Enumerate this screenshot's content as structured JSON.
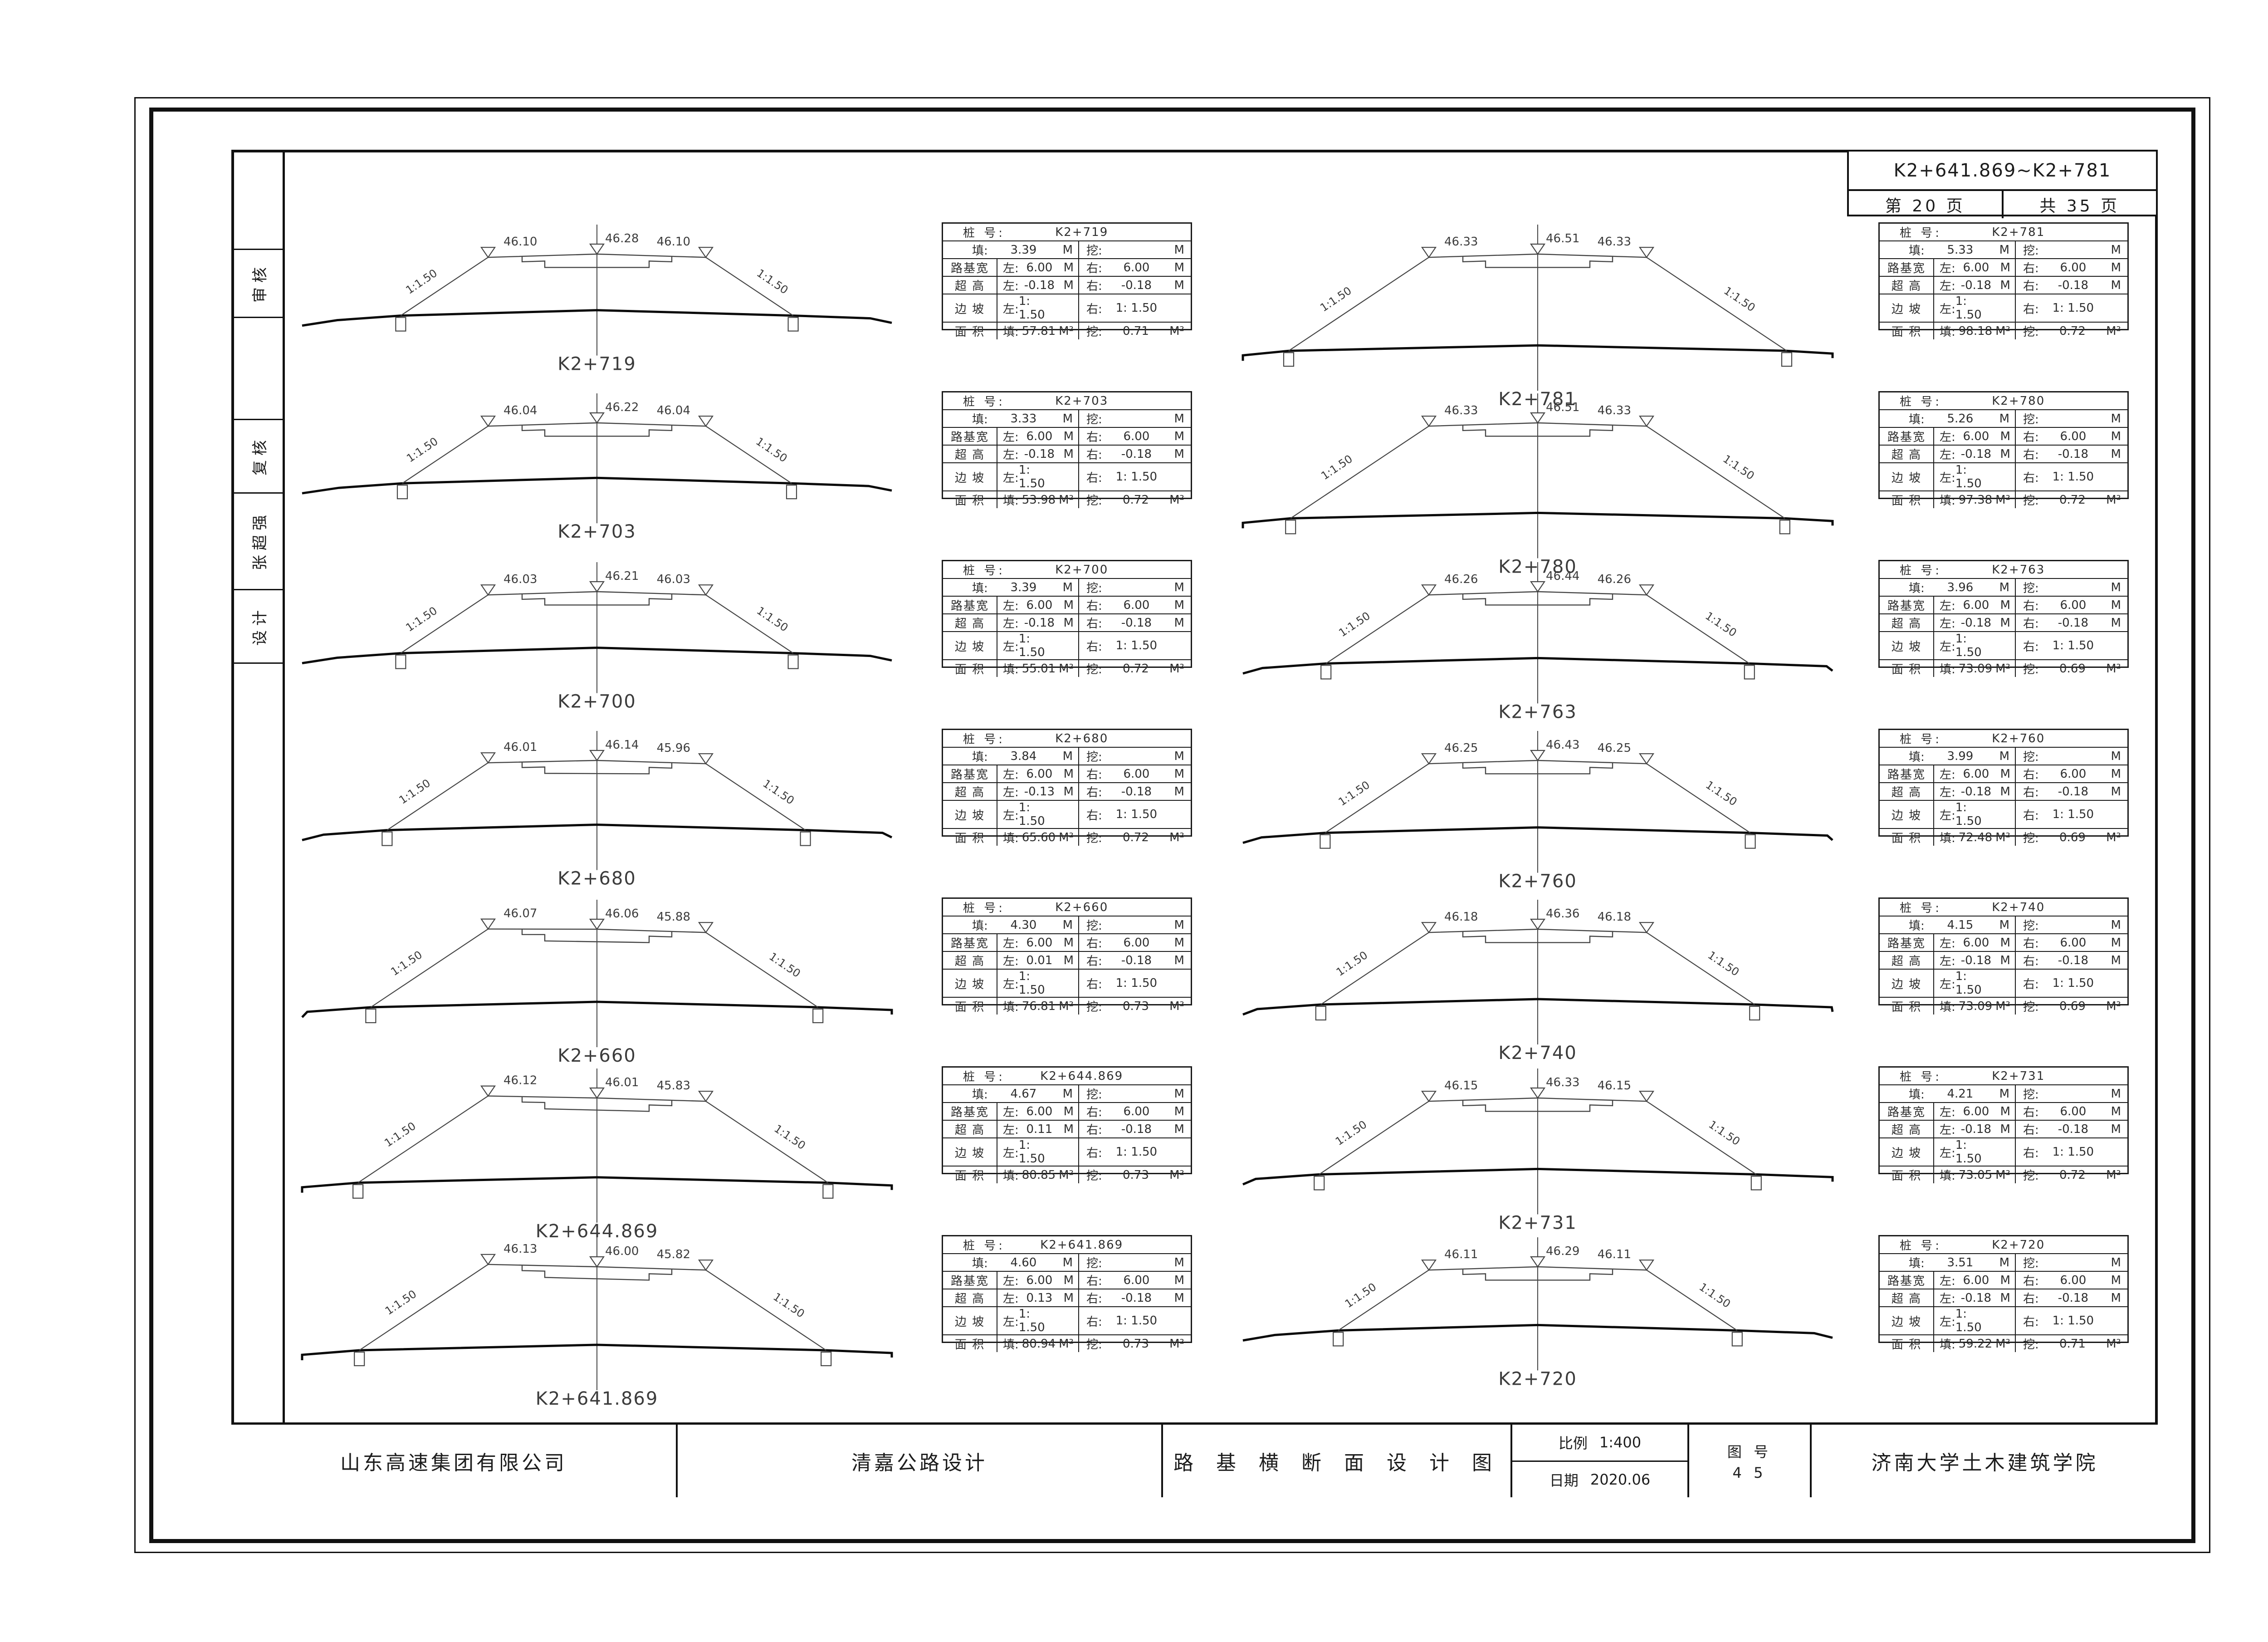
{
  "header": {
    "range": "K2+641.869~K2+781",
    "page": "第 20 页",
    "total": "共 35 页"
  },
  "sidebar": {
    "labels": [
      "审核",
      "复核",
      "张超强",
      "设计"
    ]
  },
  "titleblock": {
    "company": "山东高速集团有限公司",
    "project": "清嘉公路设计",
    "title": "路 基 横 断 面 设 计 图",
    "scale_label": "比例",
    "scale_value": "1:400",
    "date_label": "日期",
    "date_value": "2020.06",
    "figno_label": "图 号",
    "figno_value": "4 5",
    "institute": "济南大学土木建筑学院"
  },
  "table_labels": {
    "station": "桩 号:",
    "fill": "填:",
    "cut": "挖:",
    "roadbed_width": "路基宽",
    "superelevation": "超 高",
    "side_slope": "边 坡",
    "area": "面 积",
    "left": "左:",
    "right": "右:",
    "unit_m": "M",
    "unit_m2": "M²"
  },
  "sections": {
    "left_column": [
      {
        "station": "K2+719",
        "elev_left": "46.10",
        "elev_center": "46.28",
        "elev_right": "46.10",
        "slope_left": "1:1.50",
        "slope_right": "1:1.50",
        "table": {
          "fill_h": "3.39",
          "cut_h": "",
          "width_left": "6.00",
          "width_right": "6.00",
          "super_left": "-0.18",
          "super_right": "-0.18",
          "slope_left": "1: 1.50",
          "slope_right": "1: 1.50",
          "area_fill": "57.81",
          "area_cut": "0.71"
        }
      },
      {
        "station": "K2+703",
        "elev_left": "46.04",
        "elev_center": "46.22",
        "elev_right": "46.04",
        "slope_left": "1:1.50",
        "slope_right": "1:1.50",
        "table": {
          "fill_h": "3.33",
          "cut_h": "",
          "width_left": "6.00",
          "width_right": "6.00",
          "super_left": "-0.18",
          "super_right": "-0.18",
          "slope_left": "1: 1.50",
          "slope_right": "1: 1.50",
          "area_fill": "53.98",
          "area_cut": "0.72"
        }
      },
      {
        "station": "K2+700",
        "elev_left": "46.03",
        "elev_center": "46.21",
        "elev_right": "46.03",
        "slope_left": "1:1.50",
        "slope_right": "1:1.50",
        "table": {
          "fill_h": "3.39",
          "cut_h": "",
          "width_left": "6.00",
          "width_right": "6.00",
          "super_left": "-0.18",
          "super_right": "-0.18",
          "slope_left": "1: 1.50",
          "slope_right": "1: 1.50",
          "area_fill": "55.01",
          "area_cut": "0.72"
        }
      },
      {
        "station": "K2+680",
        "elev_left": "46.01",
        "elev_center": "46.14",
        "elev_right": "45.96",
        "slope_left": "1:1.50",
        "slope_right": "1:1.50",
        "table": {
          "fill_h": "3.84",
          "cut_h": "",
          "width_left": "6.00",
          "width_right": "6.00",
          "super_left": "-0.13",
          "super_right": "-0.18",
          "slope_left": "1: 1.50",
          "slope_right": "1: 1.50",
          "area_fill": "65.60",
          "area_cut": "0.72"
        }
      },
      {
        "station": "K2+660",
        "elev_left": "46.07",
        "elev_center": "46.06",
        "elev_right": "45.88",
        "slope_left": "1:1.50",
        "slope_right": "1:1.50",
        "table": {
          "fill_h": "4.30",
          "cut_h": "",
          "width_left": "6.00",
          "width_right": "6.00",
          "super_left": "0.01",
          "super_right": "-0.18",
          "slope_left": "1: 1.50",
          "slope_right": "1: 1.50",
          "area_fill": "76.81",
          "area_cut": "0.73"
        }
      },
      {
        "station": "K2+644.869",
        "elev_left": "46.12",
        "elev_center": "46.01",
        "elev_right": "45.83",
        "slope_left": "1:1.50",
        "slope_right": "1:1.50",
        "table": {
          "fill_h": "4.67",
          "cut_h": "",
          "width_left": "6.00",
          "width_right": "6.00",
          "super_left": "0.11",
          "super_right": "-0.18",
          "slope_left": "1: 1.50",
          "slope_right": "1: 1.50",
          "area_fill": "80.85",
          "area_cut": "0.73"
        }
      },
      {
        "station": "K2+641.869",
        "elev_left": "46.13",
        "elev_center": "46.00",
        "elev_right": "45.82",
        "slope_left": "1:1.50",
        "slope_right": "1:1.50",
        "table": {
          "fill_h": "4.60",
          "cut_h": "",
          "width_left": "6.00",
          "width_right": "6.00",
          "super_left": "0.13",
          "super_right": "-0.18",
          "slope_left": "1: 1.50",
          "slope_right": "1: 1.50",
          "area_fill": "80.94",
          "area_cut": "0.73"
        }
      }
    ],
    "right_column": [
      {
        "station": "K2+781",
        "elev_left": "46.33",
        "elev_center": "46.51",
        "elev_right": "46.33",
        "slope_left": "1:1.50",
        "slope_right": "1:1.50",
        "table": {
          "fill_h": "5.33",
          "cut_h": "",
          "width_left": "6.00",
          "width_right": "6.00",
          "super_left": "-0.18",
          "super_right": "-0.18",
          "slope_left": "1: 1.50",
          "slope_right": "1: 1.50",
          "area_fill": "98.18",
          "area_cut": "0.72"
        }
      },
      {
        "station": "K2+780",
        "elev_left": "46.33",
        "elev_center": "46.51",
        "elev_right": "46.33",
        "slope_left": "1:1.50",
        "slope_right": "1:1.50",
        "table": {
          "fill_h": "5.26",
          "cut_h": "",
          "width_left": "6.00",
          "width_right": "6.00",
          "super_left": "-0.18",
          "super_right": "-0.18",
          "slope_left": "1: 1.50",
          "slope_right": "1: 1.50",
          "area_fill": "97.38",
          "area_cut": "0.72"
        }
      },
      {
        "station": "K2+763",
        "elev_left": "46.26",
        "elev_center": "46.44",
        "elev_right": "46.26",
        "slope_left": "1:1.50",
        "slope_right": "1:1.50",
        "table": {
          "fill_h": "3.96",
          "cut_h": "",
          "width_left": "6.00",
          "width_right": "6.00",
          "super_left": "-0.18",
          "super_right": "-0.18",
          "slope_left": "1: 1.50",
          "slope_right": "1: 1.50",
          "area_fill": "73.09",
          "area_cut": "0.69"
        }
      },
      {
        "station": "K2+760",
        "elev_left": "46.25",
        "elev_center": "46.43",
        "elev_right": "46.25",
        "slope_left": "1:1.50",
        "slope_right": "1:1.50",
        "table": {
          "fill_h": "3.99",
          "cut_h": "",
          "width_left": "6.00",
          "width_right": "6.00",
          "super_left": "-0.18",
          "super_right": "-0.18",
          "slope_left": "1: 1.50",
          "slope_right": "1: 1.50",
          "area_fill": "72.48",
          "area_cut": "0.69"
        }
      },
      {
        "station": "K2+740",
        "elev_left": "46.18",
        "elev_center": "46.36",
        "elev_right": "46.18",
        "slope_left": "1:1.50",
        "slope_right": "1:1.50",
        "table": {
          "fill_h": "4.15",
          "cut_h": "",
          "width_left": "6.00",
          "width_right": "6.00",
          "super_left": "-0.18",
          "super_right": "-0.18",
          "slope_left": "1: 1.50",
          "slope_right": "1: 1.50",
          "area_fill": "73.09",
          "area_cut": "0.69"
        }
      },
      {
        "station": "K2+731",
        "elev_left": "46.15",
        "elev_center": "46.33",
        "elev_right": "46.15",
        "slope_left": "1:1.50",
        "slope_right": "1:1.50",
        "table": {
          "fill_h": "4.21",
          "cut_h": "",
          "width_left": "6.00",
          "width_right": "6.00",
          "super_left": "-0.18",
          "super_right": "-0.18",
          "slope_left": "1: 1.50",
          "slope_right": "1: 1.50",
          "area_fill": "73.05",
          "area_cut": "0.72"
        }
      },
      {
        "station": "K2+720",
        "elev_left": "46.11",
        "elev_center": "46.29",
        "elev_right": "46.11",
        "slope_left": "1:1.50",
        "slope_right": "1:1.50",
        "table": {
          "fill_h": "3.51",
          "cut_h": "",
          "width_left": "6.00",
          "width_right": "6.00",
          "super_left": "-0.18",
          "super_right": "-0.18",
          "slope_left": "1: 1.50",
          "slope_right": "1: 1.50",
          "area_fill": "59.22",
          "area_cut": "0.71"
        }
      }
    ]
  }
}
